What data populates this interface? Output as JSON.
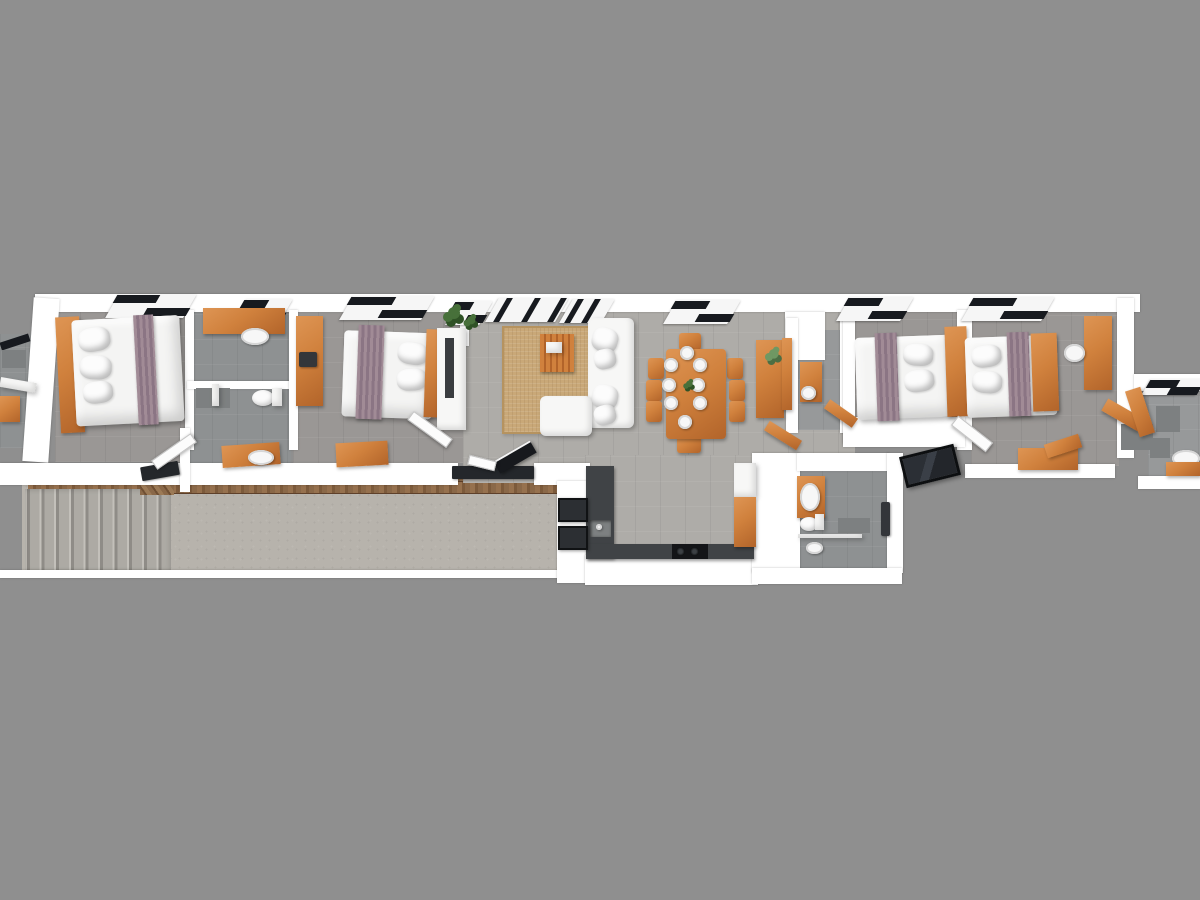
{
  "scene": {
    "description": "3D aerial render of a long single-storey apartment floor plan on a plain gray background",
    "style": "top-down 3D architectural visualization, slight isometric perspective",
    "rooms": [
      {
        "id": "edge-bathroom-left",
        "contents": [
          "counter",
          "sink",
          "floor-mat"
        ]
      },
      {
        "id": "bedroom-1",
        "contents": [
          "double-bed",
          "orange-headboard",
          "pillows",
          "mauve-runner",
          "window"
        ]
      },
      {
        "id": "ensuite-bathroom",
        "contents": [
          "orange-vanity",
          "sink",
          "shower",
          "toilet",
          "window"
        ]
      },
      {
        "id": "second-bathroom",
        "contents": [
          "orange-vanity",
          "sink",
          "shower-mat"
        ]
      },
      {
        "id": "bedroom-2",
        "contents": [
          "double-bed",
          "orange-wardrobe",
          "desk-chair",
          "mauve-runner",
          "tv-cabinet",
          "plant",
          "orange-desk",
          "windows"
        ]
      },
      {
        "id": "living-room",
        "contents": [
          "area-rug",
          "coffee-table",
          "l-shaped-sofa",
          "cushions",
          "plants",
          "windows",
          "patio-doors"
        ]
      },
      {
        "id": "dining-area",
        "contents": [
          "dining-table",
          "8-chairs",
          "8-place-settings",
          "centerpiece",
          "window"
        ]
      },
      {
        "id": "hallway",
        "contents": [
          "console-sideboard",
          "flower-decor"
        ]
      },
      {
        "id": "powder-room",
        "contents": [
          "orange-vanity",
          "round-sink"
        ]
      },
      {
        "id": "bedroom-3",
        "contents": [
          "double-bed",
          "orange-headboard",
          "pillows",
          "mauve-runner",
          "window",
          "door-mat"
        ]
      },
      {
        "id": "bedroom-4",
        "contents": [
          "double-bed",
          "orange-headboard",
          "pillows",
          "mauve-runner",
          "orange-wardrobe",
          "white-stool",
          "orange-desk",
          "window"
        ]
      },
      {
        "id": "edge-bathroom-right",
        "contents": [
          "window",
          "floor-mats",
          "sink",
          "orange-vanity",
          "orange-door"
        ]
      },
      {
        "id": "kitchen",
        "contents": [
          "u-shaped-dark-counter",
          "sink",
          "cooktop-2-burners",
          "tall-cabinet",
          "wood-cabinet",
          "outdoor-units"
        ]
      },
      {
        "id": "bathroom-rear",
        "contents": [
          "orange-vanity",
          "sink",
          "toilet",
          "shower-mat",
          "glass-screen",
          "drain"
        ]
      },
      {
        "id": "terrace",
        "contents": [
          "concrete-slab",
          "wood-trim-edge",
          "staircase-10-treads",
          "entry-mat",
          "open-door",
          "step-block"
        ]
      }
    ],
    "counts": {
      "beds": 4,
      "dining_chairs": 8,
      "plates": 8,
      "stair_treads": 10,
      "windows": 10
    },
    "window_style": "black-framed slanted glazing on white sills",
    "furniture_finish": "orange wood furniture, white bedding, mauve bed runners"
  },
  "colors": {
    "bg": "#8f8f8f",
    "wall": "#ffffff",
    "floorBedroom": "#9a9795",
    "floorLiving": "#aeaca8",
    "floorBath": "#8e9192",
    "floorBathDark": "#97999a",
    "concrete": "#b7b3ac",
    "stairTread": "#adaaa4",
    "stairEdge": "#8f8c87",
    "wood": "#8a6848",
    "woodDark": "#7c5a3b",
    "orange": "#d0813d",
    "orangeDark": "#b2642a",
    "orangeLight": "#de9554",
    "mauve": "#a18b96",
    "mauveDark": "#8b7584",
    "bedWhite": "#f4f4f3",
    "rug": "#c9a878",
    "rugDark": "#b6935f",
    "counter": "#404346",
    "cooktop": "#141518",
    "windowBlack": "#171a1f",
    "glassDark": "#17191d",
    "green": "#47703a",
    "greenDark": "#2f5226"
  }
}
